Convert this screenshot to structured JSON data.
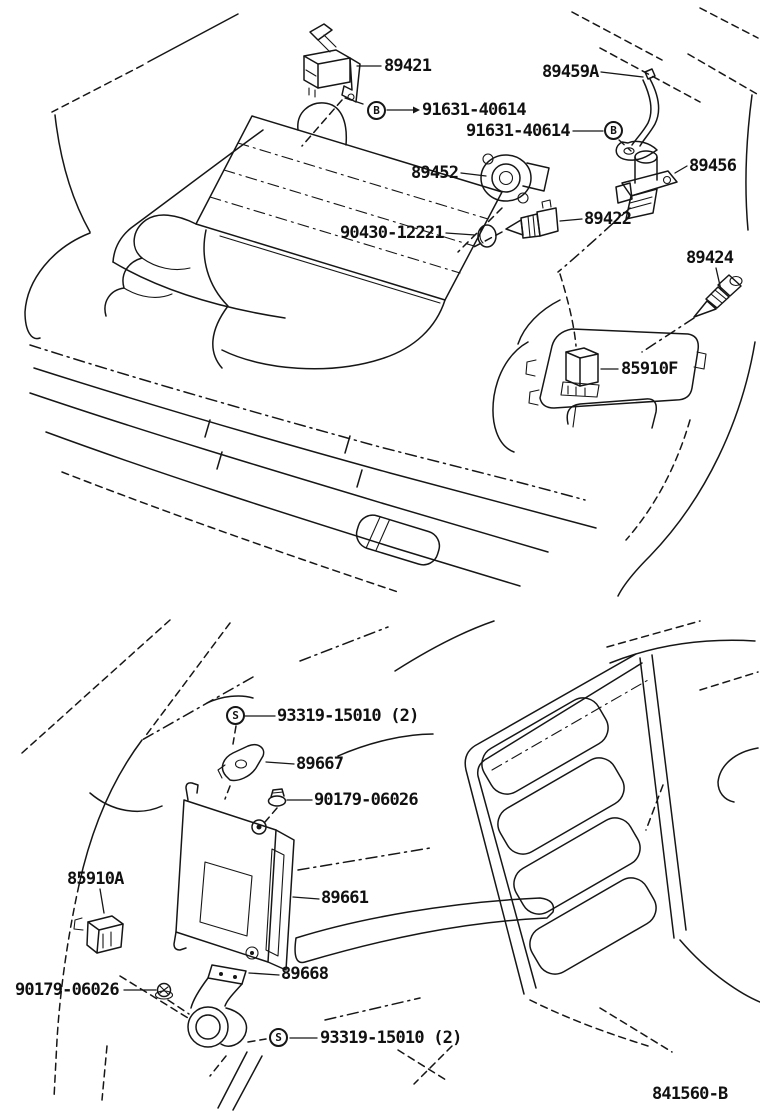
{
  "document": {
    "kind": "vehicle parts diagram, electronic fuel injection sensors & computer",
    "drawing_code": "841560-B",
    "background_color": "#ffffff",
    "line_color": "#161616"
  },
  "symbols": {
    "bolt_letter": "B",
    "screw_letter": "S"
  },
  "sections": {
    "engine_bay": {
      "name": "engine-compartment-view",
      "callouts": [
        {
          "part_number": "89421",
          "symbol": ""
        },
        {
          "part_number": "91631-40614",
          "symbol": "B"
        },
        {
          "part_number": "89459A",
          "symbol": ""
        },
        {
          "part_number": "91631-40614",
          "symbol": "B"
        },
        {
          "part_number": "89452",
          "symbol": ""
        },
        {
          "part_number": "89456",
          "symbol": ""
        },
        {
          "part_number": "89422",
          "symbol": ""
        },
        {
          "part_number": "90430-12221",
          "symbol": ""
        },
        {
          "part_number": "89424",
          "symbol": ""
        },
        {
          "part_number": "85910F",
          "symbol": ""
        }
      ]
    },
    "cabin": {
      "name": "cabin-floor-view",
      "callouts": [
        {
          "part_number": "93319-15010 (2)",
          "symbol": "S"
        },
        {
          "part_number": "89667",
          "symbol": ""
        },
        {
          "part_number": "90179-06026",
          "symbol": ""
        },
        {
          "part_number": "85910A",
          "symbol": ""
        },
        {
          "part_number": "89661",
          "symbol": ""
        },
        {
          "part_number": "89668",
          "symbol": ""
        },
        {
          "part_number": "90179-06026",
          "symbol": ""
        },
        {
          "part_number": "93319-15010 (2)",
          "symbol": "S"
        }
      ]
    }
  }
}
